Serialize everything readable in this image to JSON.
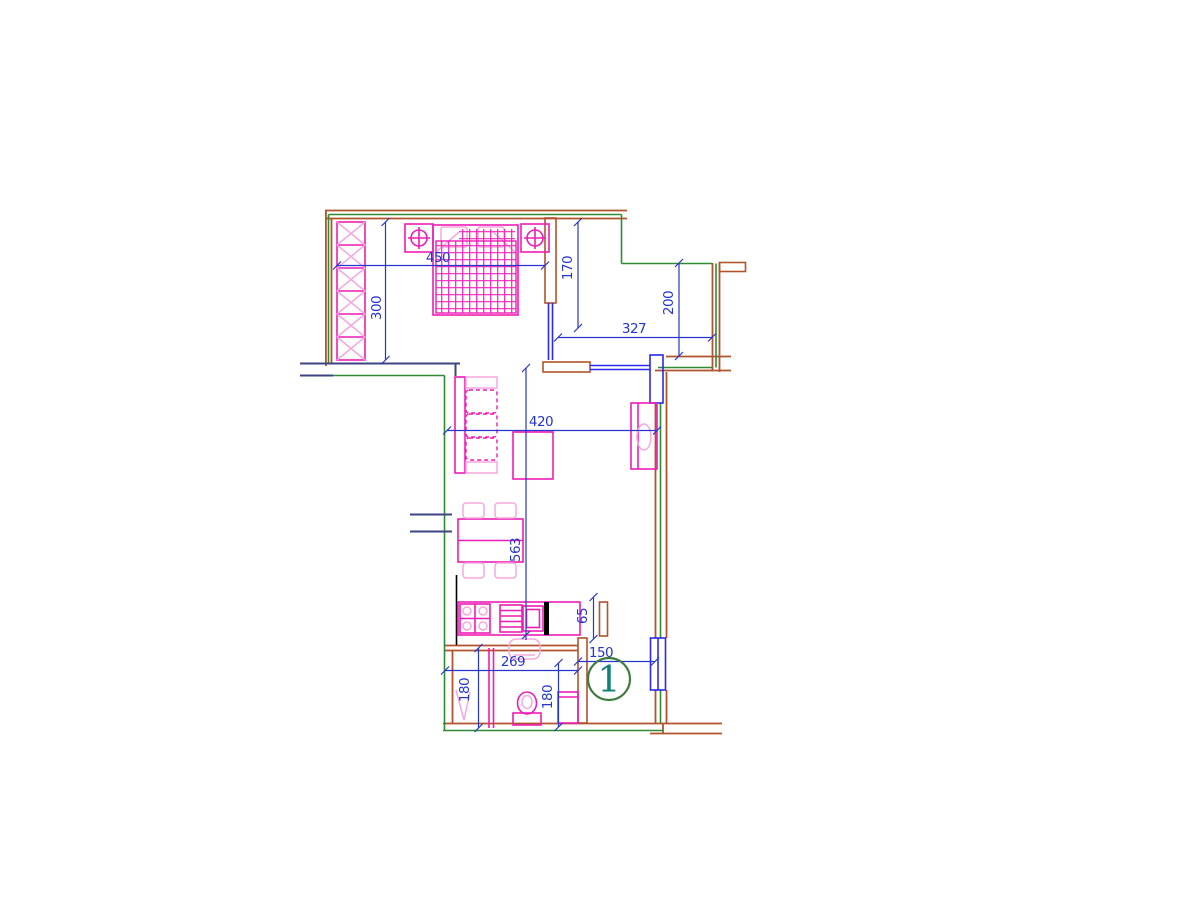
{
  "page": {
    "background": "#ffffff"
  },
  "drawing": {
    "kind": "apartment-floor-plan",
    "unit_badge": {
      "number": "1"
    },
    "dimensions": {
      "bedroom_width": "450",
      "bedroom_depth": "300",
      "closet_wall": "170",
      "upper_right_width": "327",
      "upper_right_depth": "200",
      "living_width": "420",
      "living_length": "563",
      "counter_depth": "65",
      "bathroom_width": "269",
      "hall_width": "150",
      "bath_left_depth": "180",
      "bath_right_depth": "180"
    }
  },
  "colors": {
    "background": "#ffffff",
    "wall": "#b0542b",
    "green": "#2f8b33",
    "navy": "#3c4484",
    "window": "#2a2af0",
    "dim": "#2536cc",
    "furniture": "#ee1cb6",
    "furniture_light": "#f6a8de",
    "badge": "#3e7b3e",
    "number": "#0f8177",
    "black": "#000000"
  }
}
